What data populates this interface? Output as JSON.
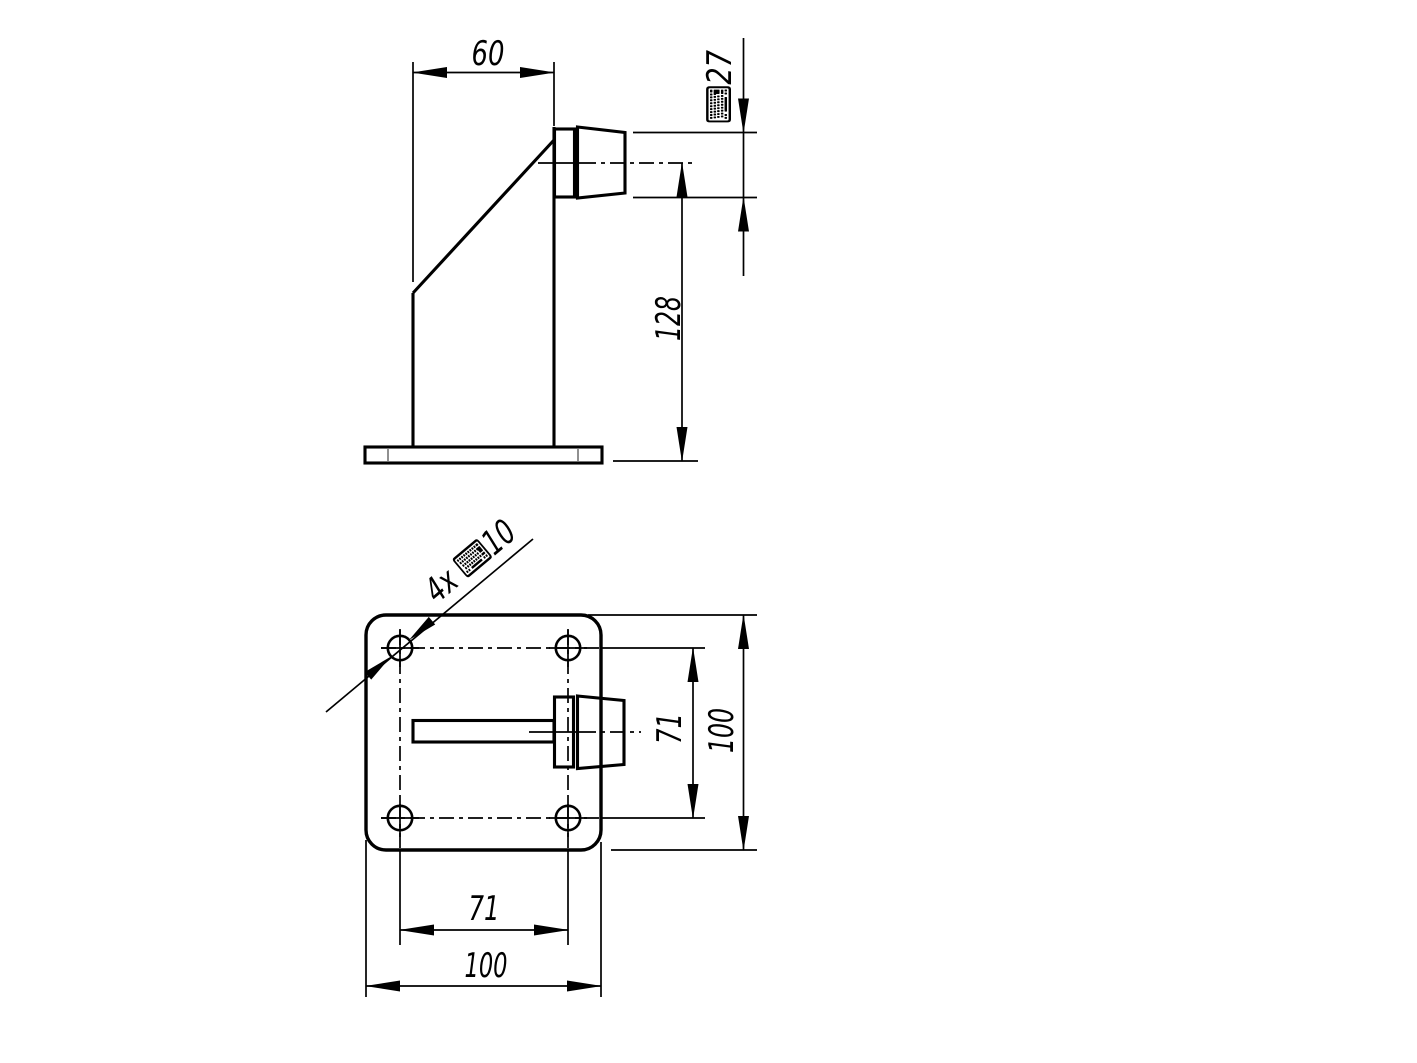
{
  "canvas": {
    "background": "#ffffff",
    "line_color": "#000000",
    "tangent_line_color": "#909090"
  },
  "front_view": {
    "title": "side elevation",
    "dim_top_width": "60",
    "dim_head_diameter": "⌨27",
    "dim_height": "128"
  },
  "plan_view": {
    "title": "plan view",
    "callout_holes": "4x ⌨10",
    "dim_hole_spacing_vertical": "71",
    "dim_plate_depth": "100",
    "dim_hole_spacing_horizontal": "71",
    "dim_plate_width": "100"
  }
}
